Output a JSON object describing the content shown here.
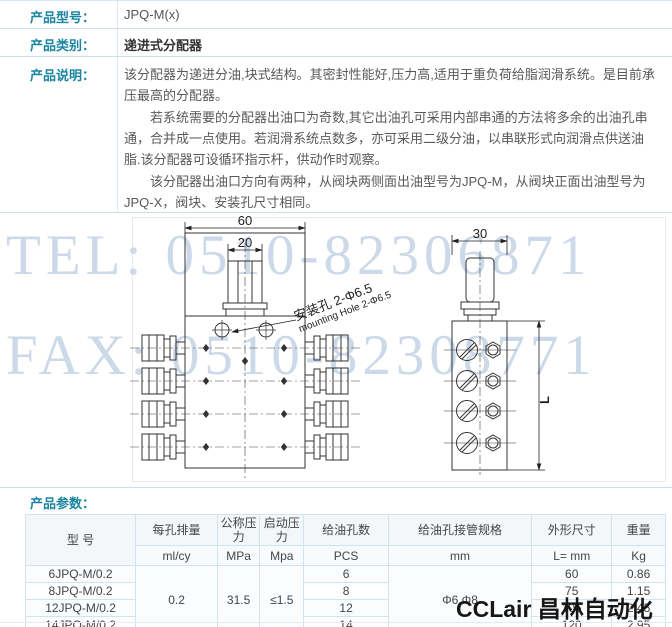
{
  "colors": {
    "accent_teal": "#1b85a1",
    "row_border": "#c9dfeb",
    "table_border": "#d2e3ed",
    "watermark_blue": "#ccd9e8"
  },
  "spec": {
    "model_label": "产品型号：",
    "model_value": "JPQ-M(x)",
    "category_label": "产品类别：",
    "category_value": "递进式分配器",
    "description_label": "产品说明：",
    "description_p1": "该分配器为递进分油,块式结构。其密封性能好,压力高,适用于重负荷给脂润滑系统。是目前承压最高的分配器。",
    "description_p2": "若系统需要的分配器出油口为奇数,其它出油孔可采用内部串通的方法将多余的出油孔串通，合并成一点使用。若润滑系统点数多，亦可采用二级分油，以串联形式向润滑点供送油脂.该分配器可设循环指示杆，供动作时观察。",
    "description_p3": "该分配器出油口方向有两种，从阀块两侧面出油型号为JPQ-M，从阀块正面出油型号为JPQ-X，阀块、安装孔尺寸相同。"
  },
  "diagram": {
    "watermark_tel": "TEL: 0510-82306871",
    "watermark_fax": "FAX: 0510-82308771",
    "dim_front_width": "60",
    "dim_inlet_width": "20",
    "dim_side_width": "30",
    "dim_length_label": "L",
    "annotation_cn": "安装孔 2-Φ6.5",
    "annotation_en": "mounting Hole 2-Φ6.5"
  },
  "params": {
    "section_label": "产品参数：",
    "table": {
      "headers": {
        "model": "型  号",
        "displacement": "每孔排量",
        "nominal_pressure": "公称压力",
        "start_pressure": "启动压力",
        "oil_holes": "给油孔数",
        "pipe_spec": "给油孔接管规格",
        "dimensions": "外形尺寸",
        "weight": "重量"
      },
      "units": {
        "displacement": "ml/cy",
        "nominal_pressure": "MPa",
        "start_pressure": "Mpa",
        "oil_holes": "PCS",
        "pipe_spec": "mm",
        "dimensions": "L= mm",
        "weight": "Kg"
      },
      "shared": {
        "displacement": "0.2",
        "nominal_pressure": "31.5",
        "start_pressure": "≤1.5",
        "pipe_spec": "Φ6 Φ8"
      },
      "rows": [
        {
          "model": "6JPQ-M/0.2",
          "holes": "6",
          "length": "60",
          "weight": "0.86"
        },
        {
          "model": "8JPQ-M/0.2",
          "holes": "8",
          "length": "75",
          "weight": "1.15"
        },
        {
          "model": "12JPQ-M/0.2",
          "holes": "12",
          "length": "105",
          "weight": "2.45"
        },
        {
          "model": "14JPQ-M/0.2",
          "holes": "14",
          "length": "120",
          "weight": "2.95"
        }
      ]
    }
  },
  "footer_watermark": "CCLair 昌林自动化"
}
